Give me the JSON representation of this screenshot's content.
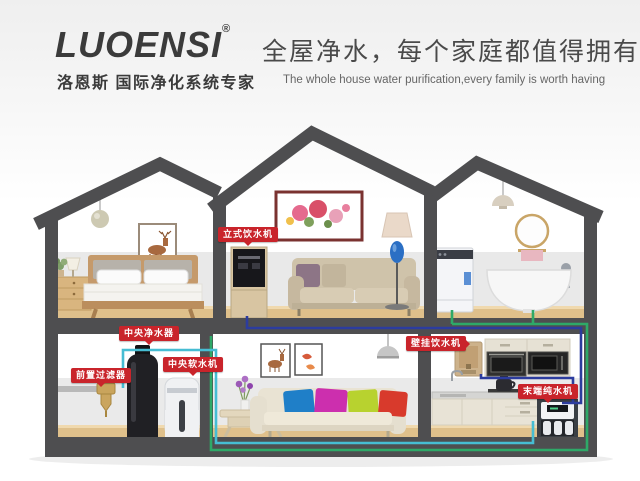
{
  "header": {
    "brand": "LUOENSI",
    "registered_mark": "®",
    "brand_sub": "洛恩斯 国际净化系统专家",
    "slogan_cn": "全屋净水，每个家庭都值得拥有",
    "slogan_en": "The whole house water purification,every family is worth having"
  },
  "device_labels": {
    "standing_dispenser": "立式饮水机",
    "central_purifier": "中央净水器",
    "pre_filter": "前置过滤器",
    "central_softener": "中央软水机",
    "wall_dispenser": "壁挂饮水机",
    "terminal_purifier": "末端纯水机"
  },
  "colors": {
    "label_red": "#c9242b",
    "pipe_blue": "#2c3c9e",
    "pipe_green": "#2ea968",
    "pipe_cyan": "#46bdd3",
    "structure_gray": "#4e4e50",
    "floor_wood": "#dfc08b"
  }
}
